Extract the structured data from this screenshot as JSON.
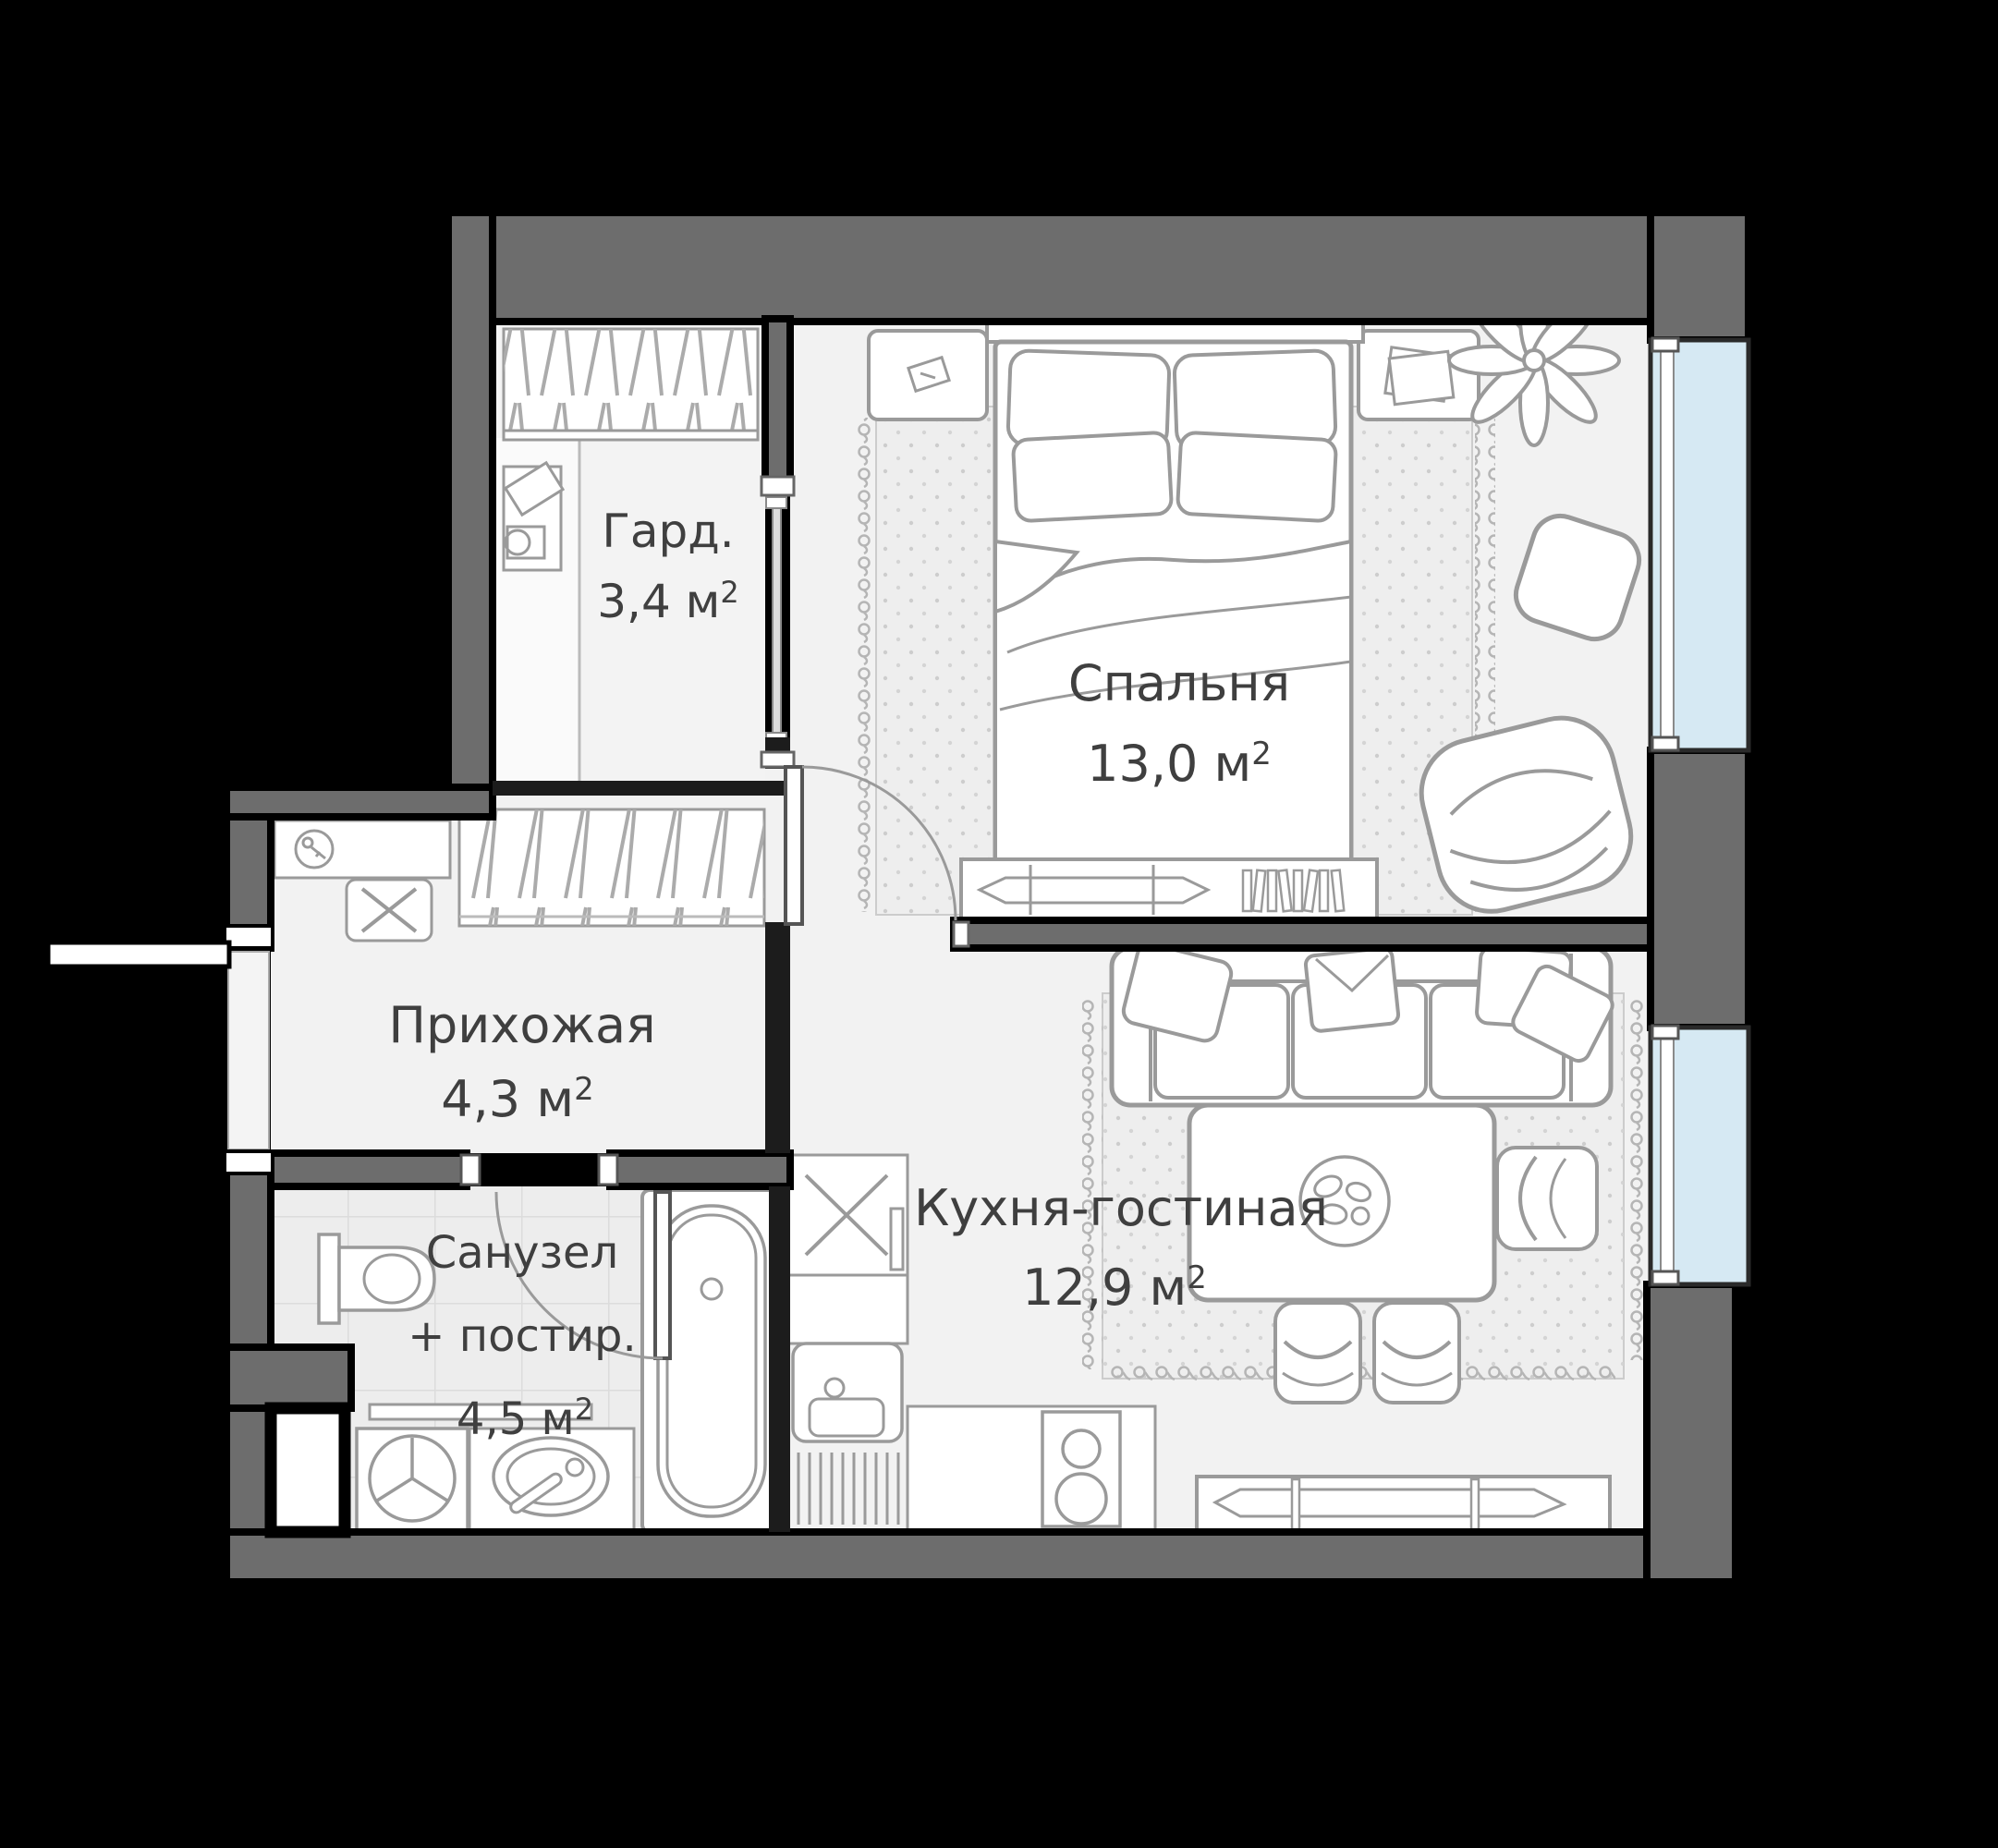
{
  "plan_type": "apartment-floor-plan",
  "colors": {
    "background": "#000000",
    "exterior_wall": "#6d6d6d",
    "partition_wall": "#1c1c1c",
    "floor": "#f2f2f2",
    "bathroom_floor": "#ededed",
    "window_glass": "#d6e9f3",
    "furniture_line": "#9a9a9a",
    "label_text": "#3f3f3f"
  },
  "rooms": {
    "wardrobe": {
      "name": "Гард.",
      "area": "3,4 м",
      "sup": "2"
    },
    "bedroom": {
      "name": "Спальня",
      "area": "13,0 м",
      "sup": "2"
    },
    "hallway": {
      "name": "Прихожая",
      "area": "4,3 м",
      "sup": "2"
    },
    "bathroom": {
      "name_line1": "Санузел",
      "name_line2": "+ постир.",
      "area": "4,5 м",
      "sup": "2"
    },
    "kitchen": {
      "name": "Кухня-гостиная",
      "area": "12,9 м",
      "sup": "2"
    }
  },
  "furniture": [
    "double-bed",
    "pillows",
    "blanket",
    "nightstand-left",
    "nightstand-right",
    "bedroom-rug",
    "plant",
    "ottoman",
    "armchair",
    "tv-console",
    "books-row",
    "sofa",
    "sofa-pillows",
    "living-rug",
    "dining-table",
    "plate",
    "chair",
    "kitchen-cabinet-x",
    "fridge-cabinet",
    "kitchen-sink",
    "drainboard",
    "stove-two-burners",
    "sideboard",
    "bathtub",
    "toilet",
    "washing-machine",
    "washbasin",
    "shelf",
    "vent-shaft",
    "wardrobe-rails",
    "hallway-rails",
    "desk",
    "key-shelf",
    "entrance-door",
    "interior-door",
    "window"
  ]
}
